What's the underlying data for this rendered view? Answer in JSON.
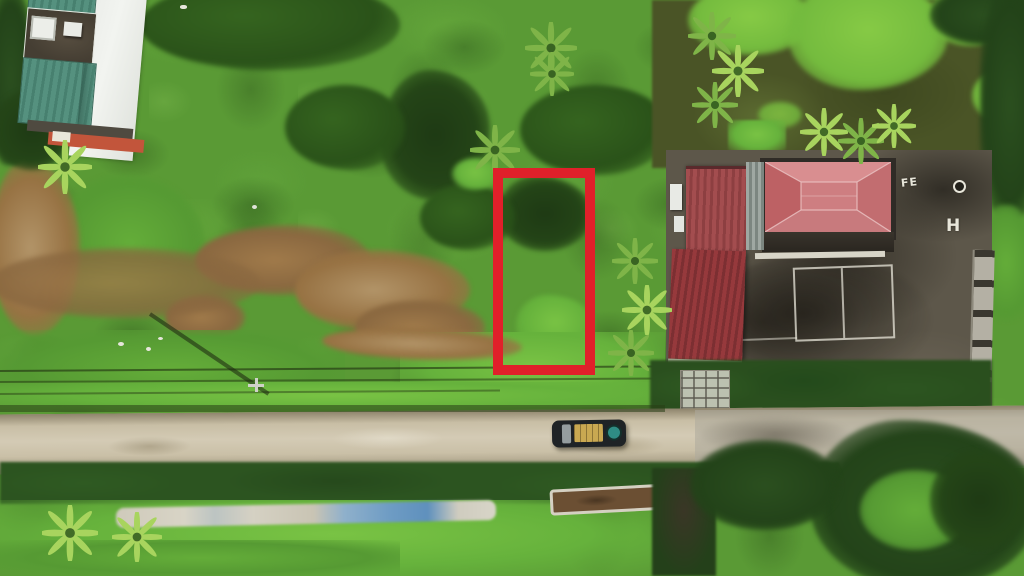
{
  "scene": {
    "type": "aerial-drone-photo",
    "description": "Top-down drone photograph of a rural land parcel: green marsh fields, a red rectangular boundary marker highlighting a plot, a white-and-teal roofed house upper-left, a compound with salmon hip roof and red corrugated roofs with a dark concrete yard on the right, a tan dirt road with a dark vehicle running across the bottom, and nursery beds with tarps below the road."
  },
  "plot_marker": {
    "purpose": "highlighted land plot boundary",
    "color": "#e0202a",
    "x": 493,
    "y": 168,
    "width": 102,
    "height": 207,
    "border_px": 10
  },
  "yard_markings": {
    "fe": "FE",
    "h": "H"
  },
  "palette": {
    "field_green": "#5a9a35",
    "bright_green": "#79c344",
    "dark_vegetation": "#1e3a14",
    "pond_olive": "#4a5426",
    "duckweed": "#86ca45",
    "dry_brown": "#977243",
    "road_tan": "#cdc3ab",
    "concrete_yard": "#5d574a",
    "hip_roof_salmon": "#c97a7d",
    "corrugated_red": "#9e4748",
    "teal_roof": "#55917f",
    "white_roof": "#e9ebe7",
    "marker_red": "#e0202a",
    "vehicle_body": "#1f2326",
    "vehicle_bed": "#c9a851",
    "vehicle_disc": "#2f8c84",
    "tarp_blue": "#6e9cc4",
    "tarp_white": "#d8d4c6"
  }
}
